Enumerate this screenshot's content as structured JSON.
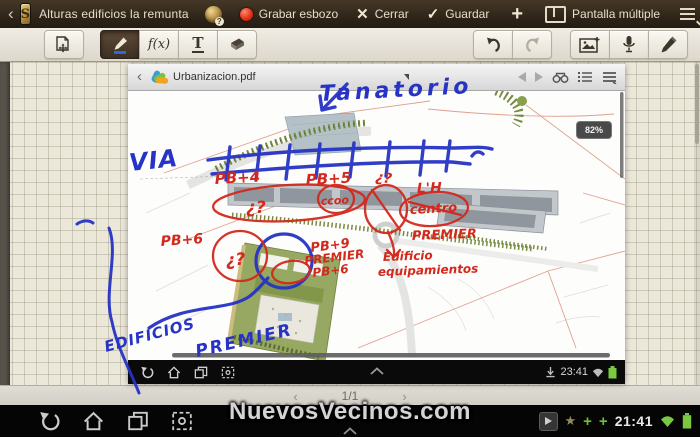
{
  "app_bar": {
    "back_icon": "‹",
    "title": "Alturas edificios la remunta",
    "record_label": "Grabar esbozo",
    "close_label": "Cerrar",
    "save_label": "Guardar",
    "add_label": "+",
    "multi_window_label": "Pantalla múltiple"
  },
  "toolbar": {
    "formula_label": "f(x)",
    "text_tool_label": "T"
  },
  "pdf_viewer": {
    "back_icon": "‹",
    "filename": "Urbanizacion.pdf",
    "zoom_level": "82%",
    "status_bar": {
      "time": "23:41"
    }
  },
  "note_nav": {
    "prev_icon": "‹",
    "page_indicator": "1/1",
    "next_icon": "›"
  },
  "watermark": "NuevosVecinos.com",
  "system_bar": {
    "time": "21:41",
    "star_icon": "★",
    "plus_left": "+",
    "plus_right": "+"
  },
  "ink": {
    "blue_color": "#2633c5",
    "red_color": "#d2291c",
    "tanatorio": "Tanatorio",
    "via": "VIA",
    "pb4": "PB+4",
    "pb5": "PB+5",
    "question_top": "¿?",
    "question_main": "¿?",
    "ccoo": "ccoo",
    "lh": "L'H",
    "centro": "centro",
    "premier_right": "PREMIER",
    "pb6_left": "PB+6",
    "question_circle": "¿?",
    "pb9": "PB+9",
    "premier_mid": "PREMIER",
    "pb6_mid": "PB+6",
    "edificio_line1": "Edificio",
    "edificio_line2": "equipamientos",
    "edificios_line1": "EDIFICIOS",
    "edificios_line2": "PREMIER"
  }
}
